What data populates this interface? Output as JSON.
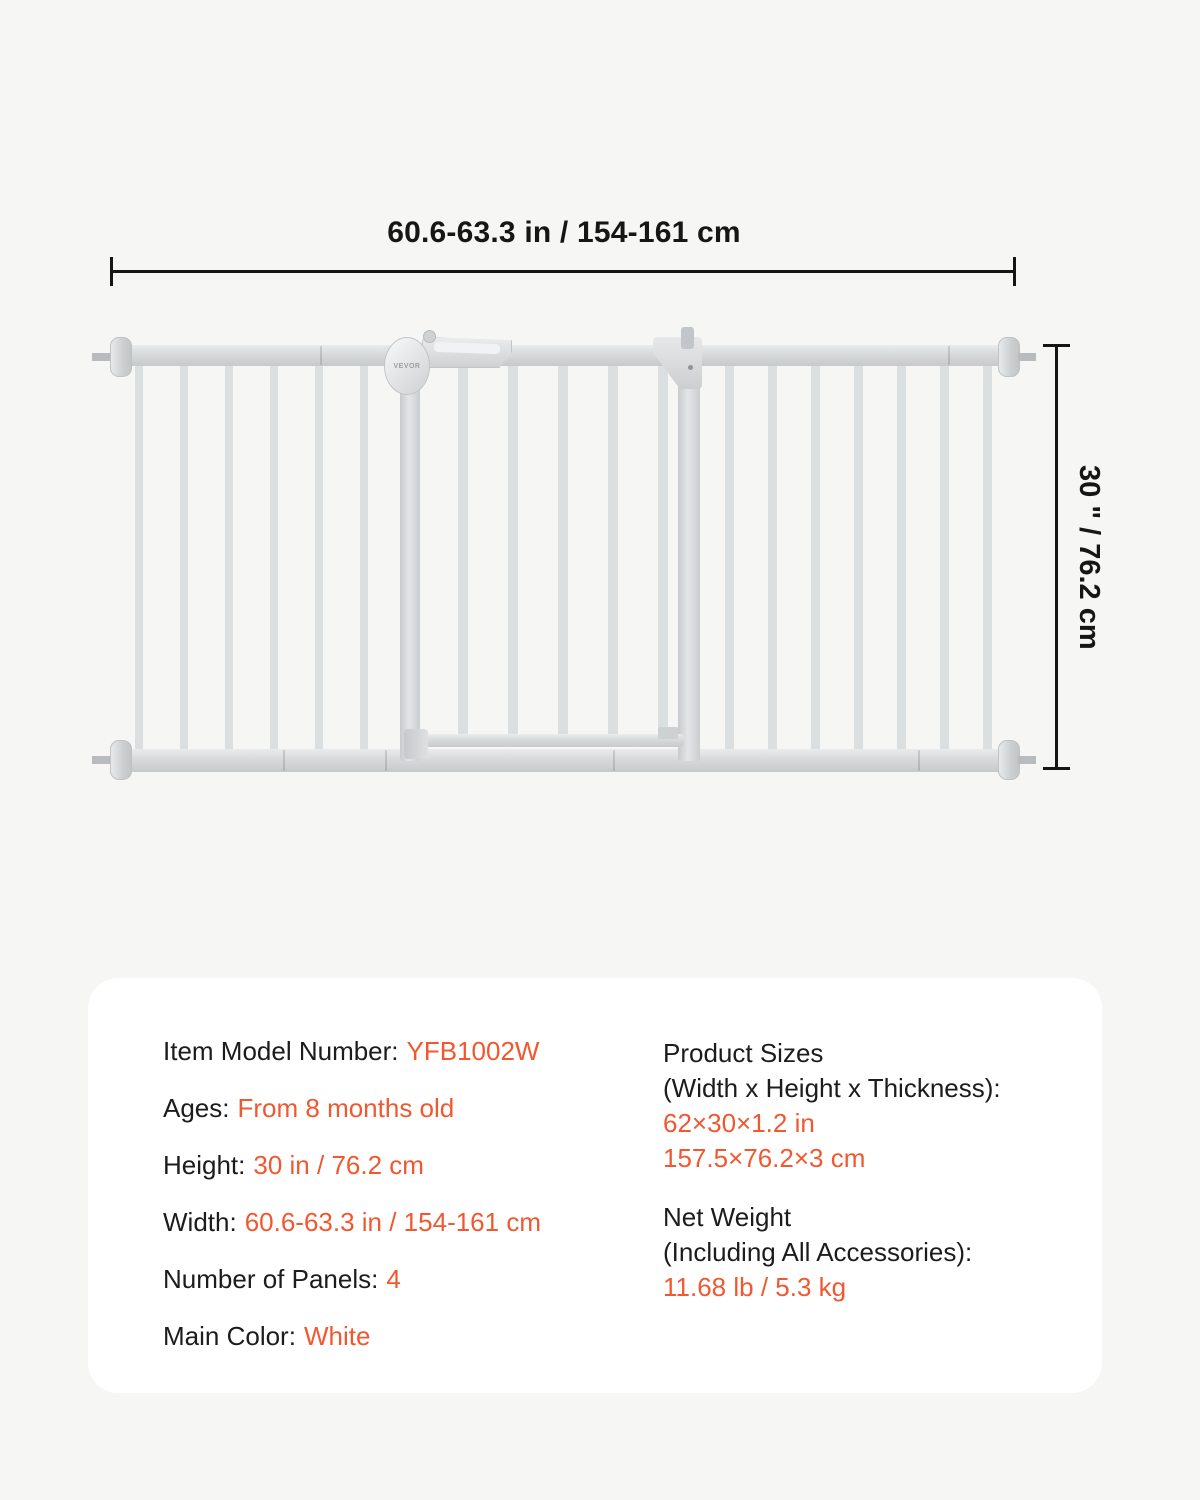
{
  "page": {
    "background": "#f6f6f4",
    "accent_color": "#f1582f",
    "text_color": "#1c1c1e"
  },
  "diagram": {
    "width_label": "60.6-63.3 in / 154-161 cm",
    "height_label": "30 \" / 76.2 cm",
    "brand": "VEVOR",
    "product": "white metal baby safety gate with 4 panels and walk-through door"
  },
  "specs": {
    "left": [
      {
        "label": "Item Model Number:",
        "value": "YFB1002W"
      },
      {
        "label": "Ages:",
        "value": "From 8 months old"
      },
      {
        "label": "Height:",
        "value": "30 in / 76.2 cm"
      },
      {
        "label": "Width:",
        "value": "60.6-63.3 in / 154-161 cm"
      },
      {
        "label": "Number of Panels:",
        "value": "4"
      },
      {
        "label": "Main Color:",
        "value": "White"
      }
    ],
    "right": [
      {
        "label_lines": [
          "Product Sizes",
          "(Width x Height x Thickness):"
        ],
        "value_lines": [
          "62×30×1.2 in",
          "157.5×76.2×3 cm"
        ]
      },
      {
        "label_lines": [
          "Net Weight",
          "(Including All Accessories):"
        ],
        "value_lines": [
          "11.68 lb / 5.3 kg"
        ]
      }
    ]
  }
}
